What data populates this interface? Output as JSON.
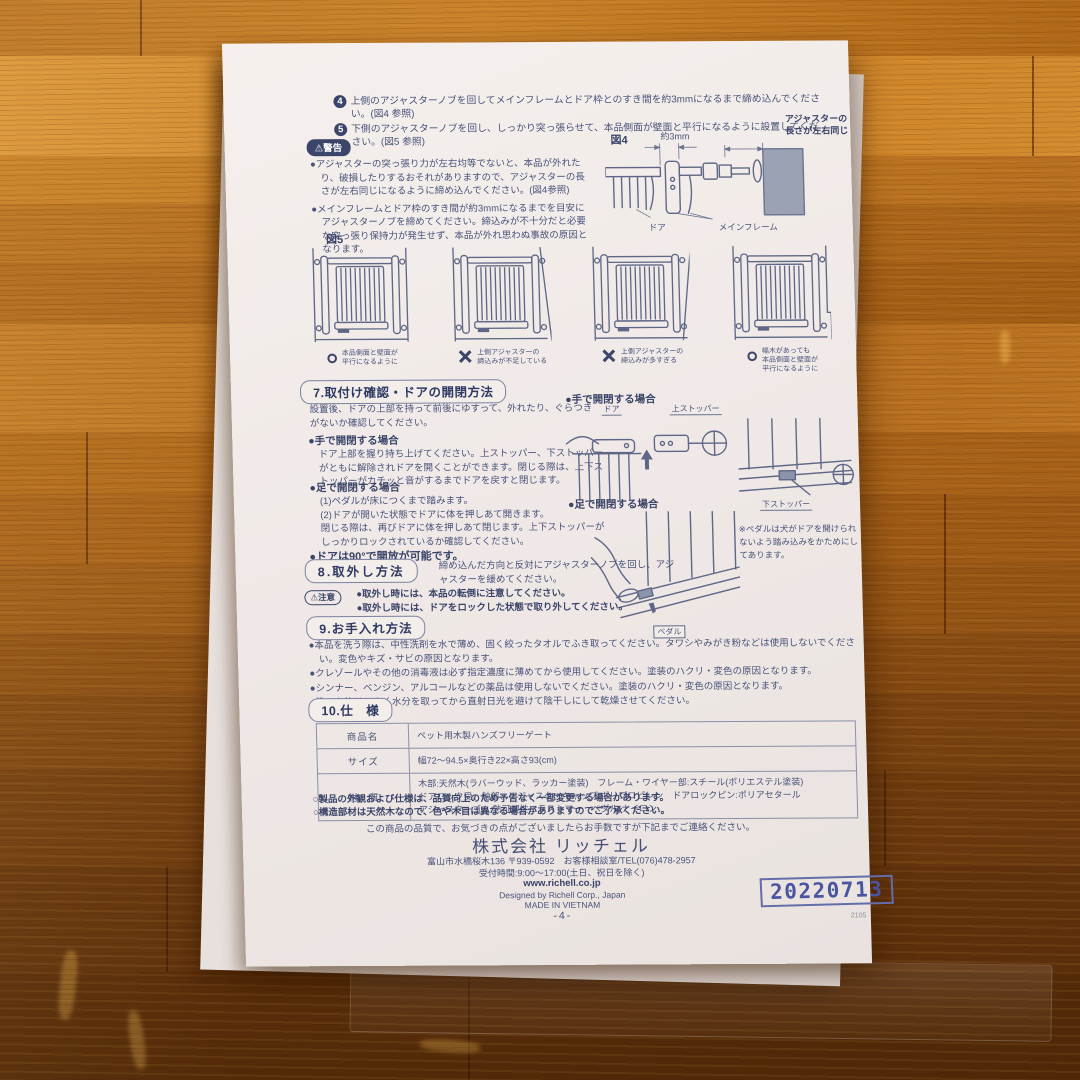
{
  "steps": [
    {
      "num": "4",
      "text": "上側のアジャスターノブを回してメインフレームとドア枠とのすき間を約3mmになるまで締め込んでください。(図4 参照)"
    },
    {
      "num": "5",
      "text": "下側のアジャスターノブを回し、しっかり突っ張らせて、本品側面が壁面と平行になるように設置してください。(図5 参照)"
    }
  ],
  "warning": {
    "icon": "⚠",
    "label": "警告",
    "items": [
      "●アジャスターの突っ張り力が左右均等でないと、本品が外れたり、破損したりするおそれがありますので、アジャスターの長さが左右同じになるように締め込んでください。(図4参照)",
      "●メインフレームとドア枠のすき間が約3mmになるまでを目安にアジャスターノブを締めてください。締込みが不十分だと必要な突っ張り保持力が発生せず、本品が外れ思わぬ事故の原因となります。"
    ]
  },
  "fig4": {
    "label": "図4",
    "dim": "約3mm",
    "note": "アジャスターの\n長さが左右同じ",
    "door": "ドア",
    "frame": "メインフレーム"
  },
  "fig5": {
    "label": "図5",
    "items": [
      {
        "mark": "○",
        "caption": "本品側面と壁面が\n平行になるように"
      },
      {
        "mark": "✕",
        "caption": "上側アジャスターの\n締込みが不足している"
      },
      {
        "mark": "✕",
        "caption": "上側アジャスターの\n締込みが多すぎる"
      },
      {
        "mark": "○",
        "caption": "幅木があっても\n本品側面と壁面が\n平行になるように"
      }
    ]
  },
  "sec7": {
    "title": "7.取付け確認・ドアの開閉方法",
    "intro": "設置後、ドアの上部を持って前後にゆすって、外れたり、ぐらつきがないか確認してください。",
    "hand_title": "●手で開閉する場合",
    "hand_body": "ドア上部を握り持ち上げてください。上ストッパー、下ストッパーがともに解除されドアを開くことができます。閉じる際は、上下ストッパーがカチッと音がするまでドアを戻すと閉じます。",
    "foot_title": "●足で開閉する場合",
    "foot_lines": [
      "(1)ペダルが床につくまで踏みます。",
      "(2)ドアが開いた状態でドアに体を押しあて開きます。",
      "閉じる際は、再びドアに体を押しあて閉じます。上下ストッパーがしっかりロックされているか確認してください。"
    ],
    "door90": "●ドアは90°で開放が可能です。"
  },
  "diagrams": {
    "hand_title": "●手で開閉する場合",
    "foot_title": "●足で開閉する場合",
    "door": "ドア",
    "top_stopper": "上ストッパー",
    "bottom_stopper": "下ストッパー",
    "pedal": "ペダル",
    "pedal_note": "※ペダルは犬がドアを開けられないよう踏み込みをかためにしてあります。"
  },
  "sec8": {
    "title": "8.取外し方法",
    "body": "締め込んだ方向と反対にアジャスターノブを回し、アジャスターを緩めてください。",
    "caution_icon": "⚠",
    "caution_label": "注意",
    "items": [
      "●取外し時には、本品の転倒に注意してください。",
      "●取外し時には、ドアをロックした状態で取り外してください。"
    ]
  },
  "sec9": {
    "title": "9.お手入れ方法",
    "items": [
      "●本品を洗う際は、中性洗剤を水で薄め、固く絞ったタオルでふき取ってください。タワシやみがき粉などは使用しないでください。変色やキズ・サビの原因となります。",
      "●クレゾールやその他の消毒液は必ず指定濃度に薄めてから使用してください。塗装のハクリ・変色の原因となります。",
      "●シンナー、ベンジン、アルコールなどの薬品は使用しないでください。塗装のハクリ・変色の原因となります。",
      "●洗った後は、よく水分を取ってから直射日光を避けて陰干しにして乾燥させてください。"
    ]
  },
  "sec10": {
    "title": "10.仕　様",
    "rows": [
      {
        "label": "商品名",
        "value": "ペット用木製ハンズフリーゲート"
      },
      {
        "label": "サイズ",
        "value": "幅72～94.5×奥行き22×高さ93(cm)"
      },
      {
        "label": "材　質",
        "value": "木部:天然木(ラバーウッド、ラッカー塗装)　フレーム・ワイヤー部:スチール(ポリエステル塗装)\nドアロック受、軸部、アジャスターキャップ:ポリプロピレン　ドアロックピン:ポリアセタール\nアジャスターゴム:熱可塑性エラストマー　ペダル:ナイロン"
      }
    ],
    "notes": [
      "○製品の外観および仕様は、品質向上のため予告なく一部変更する場合があります。",
      "○構造部材は天然木なので、色や木目は異なる場合がありますのでご了承ください。"
    ]
  },
  "footer": {
    "contact_intro": "この商品の品質で、お気づきの点がございましたらお手数ですが下記までご連絡ください。",
    "company": "株式会社 リッチェル",
    "address": "富山市水橋桜木136 〒939-0592　お客様相談室/TEL(076)478-2957",
    "hours": "受付時間:9:00～17:00(土日、祝日を除く)",
    "url": "www.richell.co.jp",
    "designed": "Designed by Richell Corp., Japan",
    "made": "MADE IN VIETNAM",
    "page_num": "-4-",
    "stamp": "20220713",
    "code": "2105"
  }
}
